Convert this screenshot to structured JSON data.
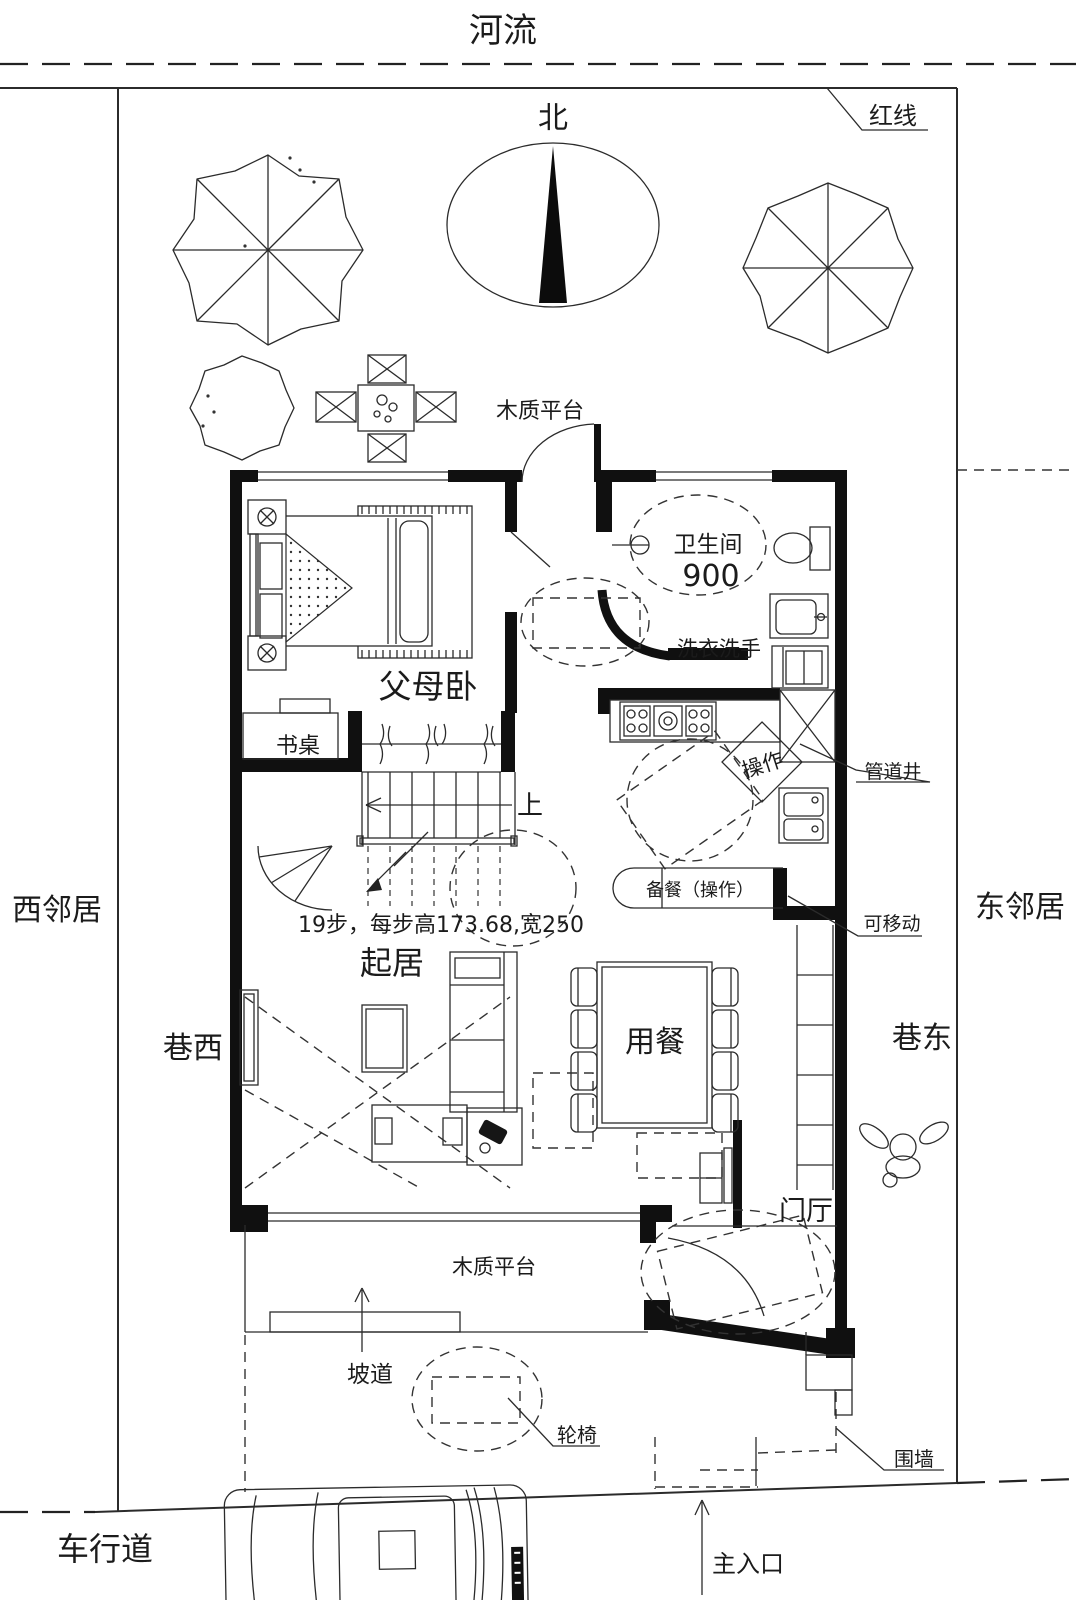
{
  "site": {
    "river": "河流",
    "north": "北",
    "red_line": "红线",
    "west_neighbor": "西邻居",
    "east_neighbor": "东邻居",
    "alley_west": "巷西",
    "alley_east": "巷东",
    "driveway": "车行道",
    "main_entrance": "主入口",
    "fence": "围墙"
  },
  "outdoor": {
    "deck_north": "木质平台",
    "deck_south": "木质平台",
    "ramp": "坡道",
    "wheelchair": "轮椅"
  },
  "rooms": {
    "parents_bedroom": "父母卧",
    "living": "起居",
    "dining": "用餐",
    "foyer": "门厅",
    "bathroom": "卫生间",
    "bathroom_turn_radius": "900",
    "laundry": "洗衣洗手"
  },
  "kitchen": {
    "worktop": "操作",
    "prep_counter": "备餐（操作）",
    "pipe_shaft": "管道井",
    "movable_partition": "可移动"
  },
  "stairs": {
    "up": "上",
    "note": "19步，每步高173.68,宽250"
  },
  "furniture": {
    "desk": "书桌"
  }
}
